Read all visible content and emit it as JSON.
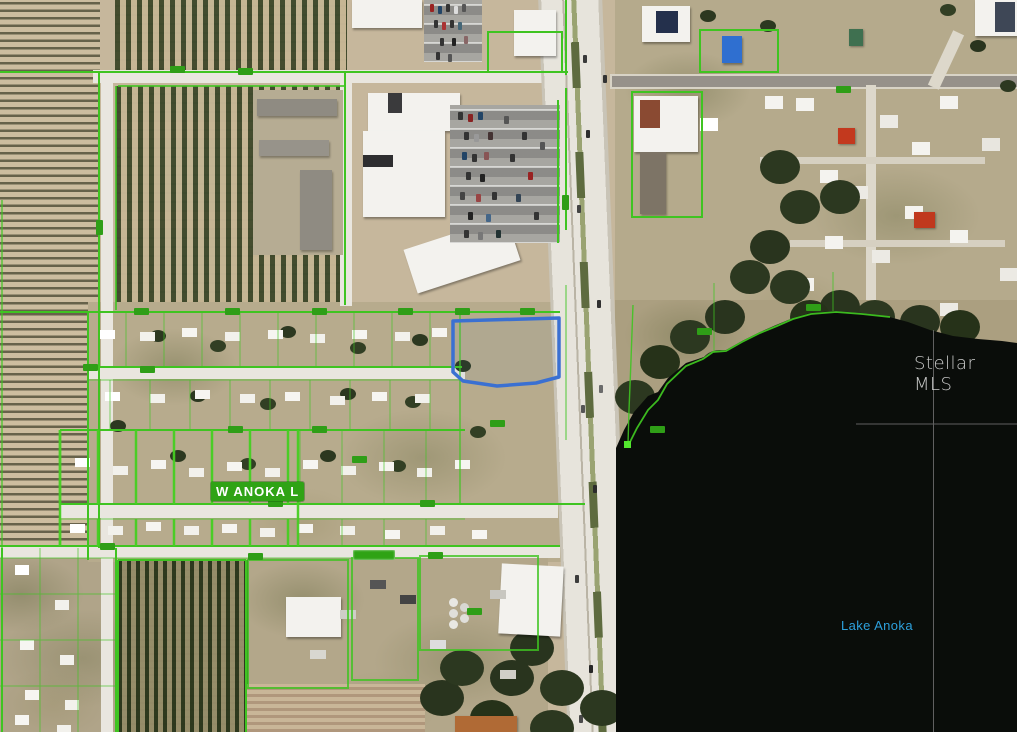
{
  "map_labels": {
    "street": "W ANOKA L",
    "lake": "Lake Anoka",
    "watermark": "Stellar MLS"
  },
  "colors": {
    "parcel_line_green": "#3fc421",
    "parcel_label_green": "#2f9e17",
    "selected_parcel_blue": "#3a70d2",
    "lake_label_blue": "#2da0dc",
    "street_label_bg": "#2fa315",
    "water_dark": "#0a0d0a",
    "survey_line_gray": "#6f6f6f"
  }
}
